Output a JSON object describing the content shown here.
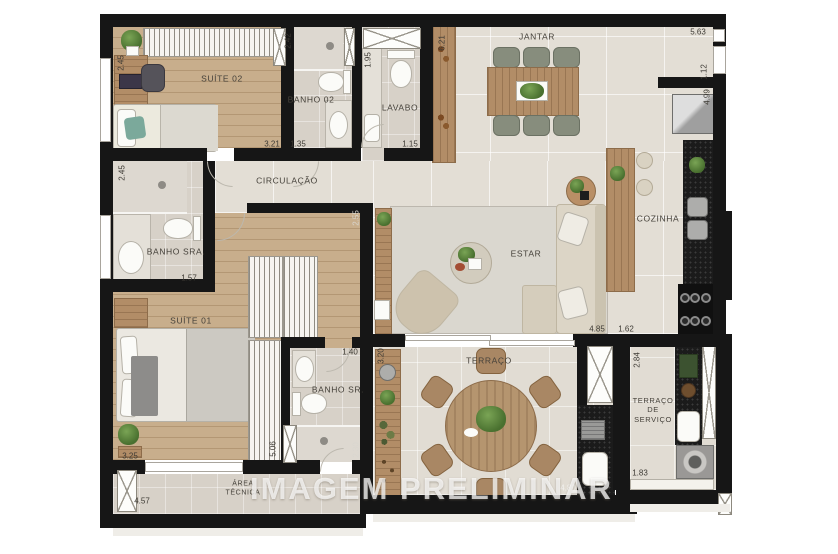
{
  "watermark": "IMAGEM PRELIMINAR",
  "rooms": {
    "suite02": "SUÍTE 02",
    "banho02": "BANHO 02",
    "lavabo": "LAVABO",
    "jantar": "JANTAR",
    "circulacao": "CIRCULAÇÃO",
    "banho_sra": "BANHO SRA.",
    "cozinha": "COZINHA",
    "estar": "ESTAR",
    "suite01": "SUÍTE 01",
    "banho_sr": "BANHO SR.",
    "terraco": "TERRAÇO",
    "terraco_servico": "TERRAÇO\nDE\nSERVIÇO",
    "area_tecnica": "ÁREA\nTÉCNICA"
  },
  "dims": {
    "suite02_depth": "2.45",
    "suite02_width": "3.21",
    "banho02_depth": "2.42",
    "banho02_width": "1.35",
    "lavabo_depth": "1.95",
    "lavabo_width": "1.15",
    "sideboard_length": "6.21",
    "jantar_width": "5.63",
    "right_notch": "1.12",
    "cozinha_length": "4.99",
    "banho_sra_depth": "2.45",
    "banho_sra_width": "1.57",
    "hall_wall": "2.55",
    "estar_width": "4.85",
    "cozinha_width": "1.62",
    "suite01_width": "3.25",
    "closet_length": "5.06",
    "banho_sr_width": "1.40",
    "banho_sr_depth": "2.30",
    "terraco_depth": "3.20",
    "terraco_width": "4.80",
    "servico_depth": "2.84",
    "servico_width": "1.83",
    "area_tecnica_width": "4.57"
  },
  "colors": {
    "walls": "#161616",
    "wood_floor": "#c8ae8c",
    "tile_floor": "#e3ded5",
    "dark_counter": "#1b1b1b",
    "furniture_wood": "#b28d67",
    "upholstery": "#dcd5c6",
    "dining_chair": "#878d7d"
  }
}
